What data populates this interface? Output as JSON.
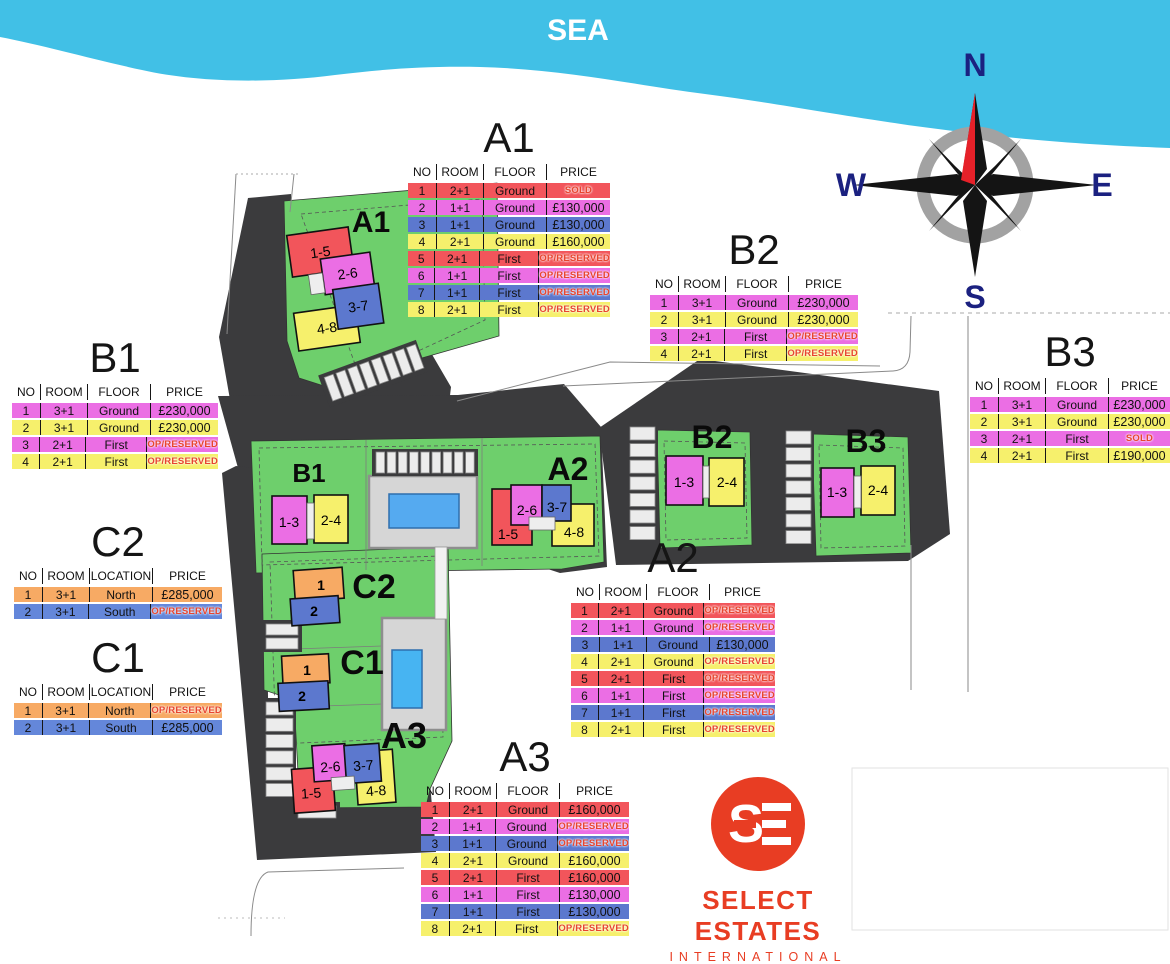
{
  "map": {
    "sea_label": "SEA",
    "compass": {
      "north": "N",
      "east": "E",
      "south": "S",
      "west": "W"
    },
    "plot_labels": {
      "a1": "A1",
      "a2": "A2",
      "a3": "A3",
      "b1": "B1",
      "b2": "B2",
      "b3": "B3",
      "c1": "C1",
      "c2": "C2"
    },
    "buildings": {
      "a1_blocks": {
        "red": "1-5",
        "violet": "2-6",
        "blue": "3-7",
        "yellow": "4-8"
      },
      "a2_blocks": {
        "red": "1-5",
        "violet": "2-6",
        "blue": "3-7",
        "yellow": "4-8"
      },
      "a3_blocks": {
        "red": "1-5",
        "violet": "2-6",
        "blue": "3-7",
        "yellow": "4-8"
      },
      "b1_blocks": {
        "violet": "1-3",
        "yellow": "2-4"
      },
      "b2_blocks": {
        "violet": "1-3",
        "yellow": "2-4"
      },
      "b3_blocks": {
        "violet": "1-3",
        "yellow": "2-4"
      },
      "c1_blocks": {
        "orange": "1",
        "blue": "2"
      },
      "c2_blocks": {
        "orange": "1",
        "blue": "2"
      }
    }
  },
  "tables": [
    {
      "id": "A1",
      "title": "A1",
      "headers": [
        "NO",
        "ROOM",
        "FLOOR",
        "PRICE"
      ],
      "rows": [
        {
          "no": "1",
          "room": "2+1",
          "mid": "Ground",
          "price": "SOLD",
          "color": "red",
          "status": true
        },
        {
          "no": "2",
          "room": "1+1",
          "mid": "Ground",
          "price": "£130,000",
          "color": "violet",
          "status": false
        },
        {
          "no": "3",
          "room": "1+1",
          "mid": "Ground",
          "price": "£130,000",
          "color": "blue",
          "status": false
        },
        {
          "no": "4",
          "room": "2+1",
          "mid": "Ground",
          "price": "£160,000",
          "color": "yellow",
          "status": false
        },
        {
          "no": "5",
          "room": "2+1",
          "mid": "First",
          "price": "OP/RESERVED",
          "color": "red",
          "status": true
        },
        {
          "no": "6",
          "room": "1+1",
          "mid": "First",
          "price": "OP/RESERVED",
          "color": "violet",
          "status": true
        },
        {
          "no": "7",
          "room": "1+1",
          "mid": "First",
          "price": "OP/RESERVED",
          "color": "blue",
          "status": true
        },
        {
          "no": "8",
          "room": "2+1",
          "mid": "First",
          "price": "OP/RESERVED",
          "color": "yellow",
          "status": true
        }
      ]
    },
    {
      "id": "B2",
      "title": "B2",
      "headers": [
        "NO",
        "ROOM",
        "FLOOR",
        "PRICE"
      ],
      "rows": [
        {
          "no": "1",
          "room": "3+1",
          "mid": "Ground",
          "price": "£230,000",
          "color": "violet",
          "status": false
        },
        {
          "no": "2",
          "room": "3+1",
          "mid": "Ground",
          "price": "£230,000",
          "color": "yellow",
          "status": false
        },
        {
          "no": "3",
          "room": "2+1",
          "mid": "First",
          "price": "OP/RESERVED",
          "color": "violet",
          "status": true
        },
        {
          "no": "4",
          "room": "2+1",
          "mid": "First",
          "price": "OP/RESERVED",
          "color": "yellow",
          "status": true
        }
      ]
    },
    {
      "id": "B1",
      "title": "B1",
      "headers": [
        "NO",
        "ROOM",
        "FLOOR",
        "PRICE"
      ],
      "rows": [
        {
          "no": "1",
          "room": "3+1",
          "mid": "Ground",
          "price": "£230,000",
          "color": "violet",
          "status": false
        },
        {
          "no": "2",
          "room": "3+1",
          "mid": "Ground",
          "price": "£230,000",
          "color": "yellow",
          "status": false
        },
        {
          "no": "3",
          "room": "2+1",
          "mid": "First",
          "price": "OP/RESERVED",
          "color": "violet",
          "status": true
        },
        {
          "no": "4",
          "room": "2+1",
          "mid": "First",
          "price": "OP/RESERVED",
          "color": "yellow",
          "status": true
        }
      ]
    },
    {
      "id": "B3",
      "title": "B3",
      "headers": [
        "NO",
        "ROOM",
        "FLOOR",
        "PRICE"
      ],
      "rows": [
        {
          "no": "1",
          "room": "3+1",
          "mid": "Ground",
          "price": "£230,000",
          "color": "violet",
          "status": false
        },
        {
          "no": "2",
          "room": "3+1",
          "mid": "Ground",
          "price": "£230,000",
          "color": "yellow",
          "status": false
        },
        {
          "no": "3",
          "room": "2+1",
          "mid": "First",
          "price": "SOLD",
          "color": "violet",
          "status": true
        },
        {
          "no": "4",
          "room": "2+1",
          "mid": "First",
          "price": "£190,000",
          "color": "yellow",
          "status": false
        }
      ]
    },
    {
      "id": "C2",
      "title": "C2",
      "headers": [
        "NO",
        "ROOM",
        "LOCATION",
        "PRICE"
      ],
      "rows": [
        {
          "no": "1",
          "room": "3+1",
          "mid": "North",
          "price": "£285,000",
          "color": "orange",
          "status": false
        },
        {
          "no": "2",
          "room": "3+1",
          "mid": "South",
          "price": "OP/RESERVED",
          "color": "cblue",
          "status": true
        }
      ]
    },
    {
      "id": "C1",
      "title": "C1",
      "headers": [
        "NO",
        "ROOM",
        "LOCATION",
        "PRICE"
      ],
      "rows": [
        {
          "no": "1",
          "room": "3+1",
          "mid": "North",
          "price": "OP/RESERVED",
          "color": "orange",
          "status": true
        },
        {
          "no": "2",
          "room": "3+1",
          "mid": "South",
          "price": "£285,000",
          "color": "cblue",
          "status": false
        }
      ]
    },
    {
      "id": "A2",
      "title": "A2",
      "headers": [
        "NO",
        "ROOM",
        "FLOOR",
        "PRICE"
      ],
      "rows": [
        {
          "no": "1",
          "room": "2+1",
          "mid": "Ground",
          "price": "OP/RESERVED",
          "color": "red",
          "status": true
        },
        {
          "no": "2",
          "room": "1+1",
          "mid": "Ground",
          "price": "OP/RESERVED",
          "color": "violet",
          "status": true
        },
        {
          "no": "3",
          "room": "1+1",
          "mid": "Ground",
          "price": "£130,000",
          "color": "blue",
          "status": false
        },
        {
          "no": "4",
          "room": "2+1",
          "mid": "Ground",
          "price": "OP/RESERVED",
          "color": "yellow",
          "status": true
        },
        {
          "no": "5",
          "room": "2+1",
          "mid": "First",
          "price": "OP/RESERVED",
          "color": "red",
          "status": true
        },
        {
          "no": "6",
          "room": "1+1",
          "mid": "First",
          "price": "OP/RESERVED",
          "color": "violet",
          "status": true
        },
        {
          "no": "7",
          "room": "1+1",
          "mid": "First",
          "price": "OP/RESERVED",
          "color": "blue",
          "status": true
        },
        {
          "no": "8",
          "room": "2+1",
          "mid": "First",
          "price": "OP/RESERVED",
          "color": "yellow",
          "status": true
        }
      ]
    },
    {
      "id": "A3",
      "title": "A3",
      "headers": [
        "NO",
        "ROOM",
        "FLOOR",
        "PRICE"
      ],
      "rows": [
        {
          "no": "1",
          "room": "2+1",
          "mid": "Ground",
          "price": "£160,000",
          "color": "red",
          "status": false
        },
        {
          "no": "2",
          "room": "1+1",
          "mid": "Ground",
          "price": "OP/RESERVED",
          "color": "violet",
          "status": true
        },
        {
          "no": "3",
          "room": "1+1",
          "mid": "Ground",
          "price": "OP/RESERVED",
          "color": "blue",
          "status": true
        },
        {
          "no": "4",
          "room": "2+1",
          "mid": "Ground",
          "price": "£160,000",
          "color": "yellow",
          "status": false
        },
        {
          "no": "5",
          "room": "2+1",
          "mid": "First",
          "price": "£160,000",
          "color": "red",
          "status": false
        },
        {
          "no": "6",
          "room": "1+1",
          "mid": "First",
          "price": "£130,000",
          "color": "violet",
          "status": false
        },
        {
          "no": "7",
          "room": "1+1",
          "mid": "First",
          "price": "£130,000",
          "color": "blue",
          "status": false
        },
        {
          "no": "8",
          "room": "2+1",
          "mid": "First",
          "price": "OP/RESERVED",
          "color": "yellow",
          "status": true
        }
      ]
    }
  ],
  "logo": {
    "monogram": "SE",
    "name": "SELECT ESTATES",
    "subtitle": "INTERNATIONAL"
  },
  "colors": {
    "sea": "#41c0e6",
    "plot_green": "#6ecf6c",
    "road_dark": "#3b3b3d",
    "row_red": "#f2555b",
    "row_violet": "#eb6ee4",
    "row_blue": "#5c78ce",
    "row_yellow": "#f6f06c",
    "row_orange": "#f7aa64",
    "row_cblue": "#6487da",
    "status_red": "#e8452f",
    "pool_blue": "#55aaf0",
    "logo_red": "#e83d23",
    "compass_navy": "#1b2180"
  }
}
